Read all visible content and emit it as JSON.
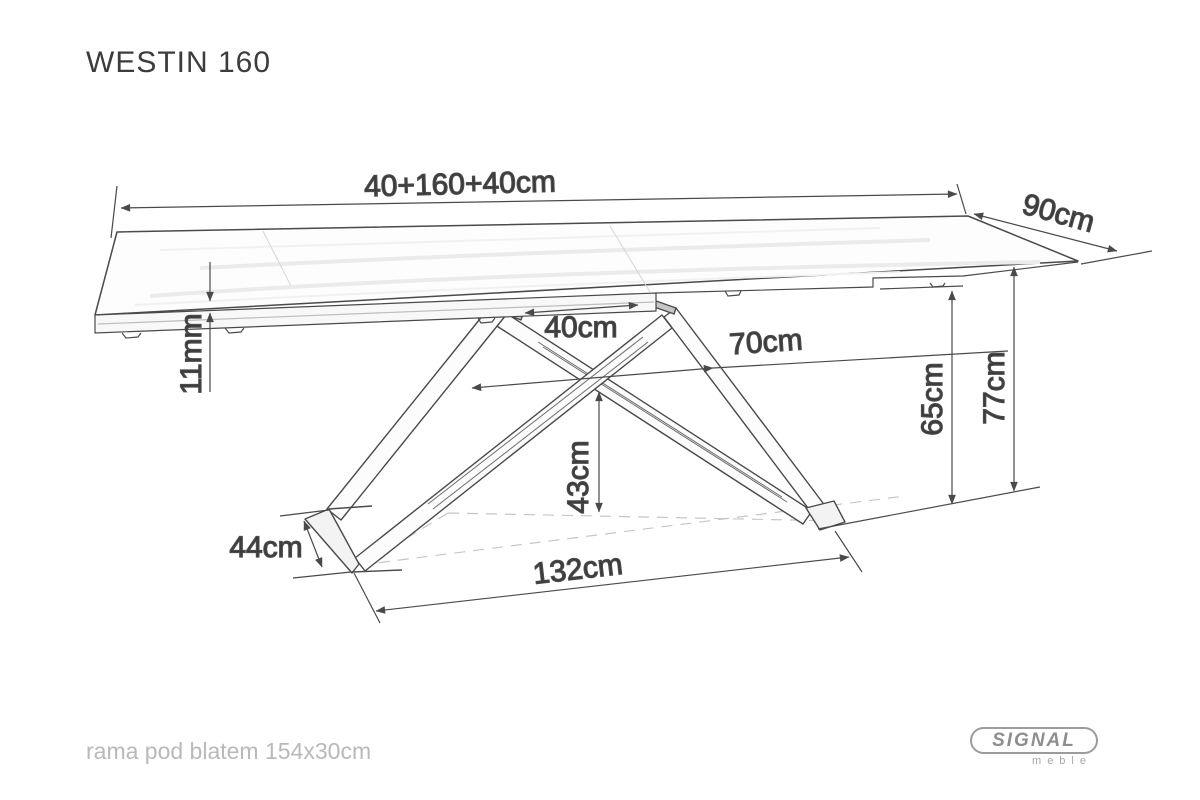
{
  "title": "WESTIN 160",
  "dimensions": {
    "top_width": "40+160+40cm",
    "top_depth": "90cm",
    "top_thickness": "11mm",
    "mount_plate_gap": "40cm",
    "base_top_depth": "70cm",
    "height_to_frame": "65cm",
    "total_height": "77cm",
    "cross_height": "43cm",
    "foot_depth": "44cm",
    "base_width": "132cm"
  },
  "footer_note": "rama pod blatem 154x30cm",
  "logo": {
    "brand": "SIGNAL",
    "subtitle": "meble"
  },
  "colors": {
    "line": "#4a4a4a",
    "dimension_text": "#3a3a3a",
    "muted_text": "#b9b9b9",
    "logo_gray": "#8e8e8e",
    "background": "#ffffff"
  }
}
